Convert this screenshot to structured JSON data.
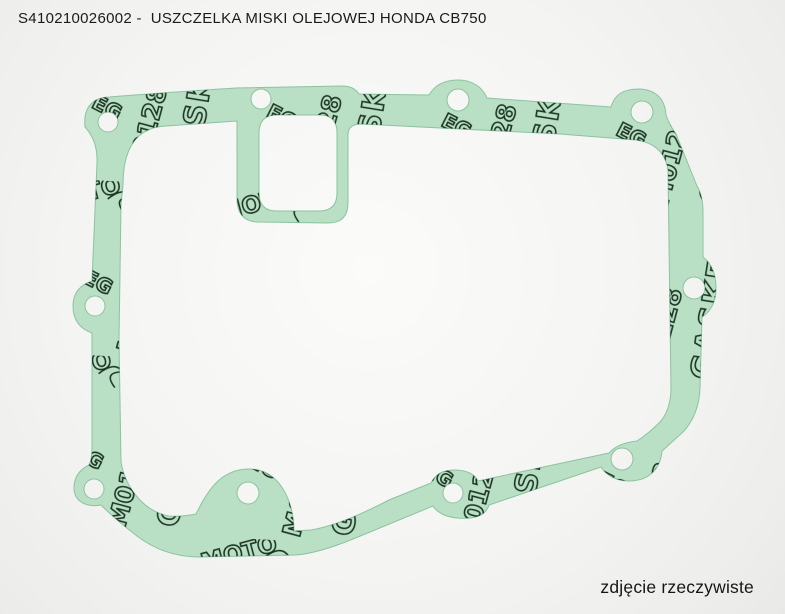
{
  "page": {
    "background_color": "#f3f3f1"
  },
  "header": {
    "title": "S410210026002 -  USZCZELKA MISKI OLEJOWEJ HONDA CB750"
  },
  "photo": {
    "caption": "zdjęcie rzeczywiste"
  },
  "gasket": {
    "material_color": "#b9e0c4",
    "edge_color": "#8cc3a0",
    "print_color": "#1c3424",
    "print_words": [
      "GASKET",
      "M0128",
      "MOTO",
      "EG"
    ],
    "bolt_hole_count": 10
  }
}
